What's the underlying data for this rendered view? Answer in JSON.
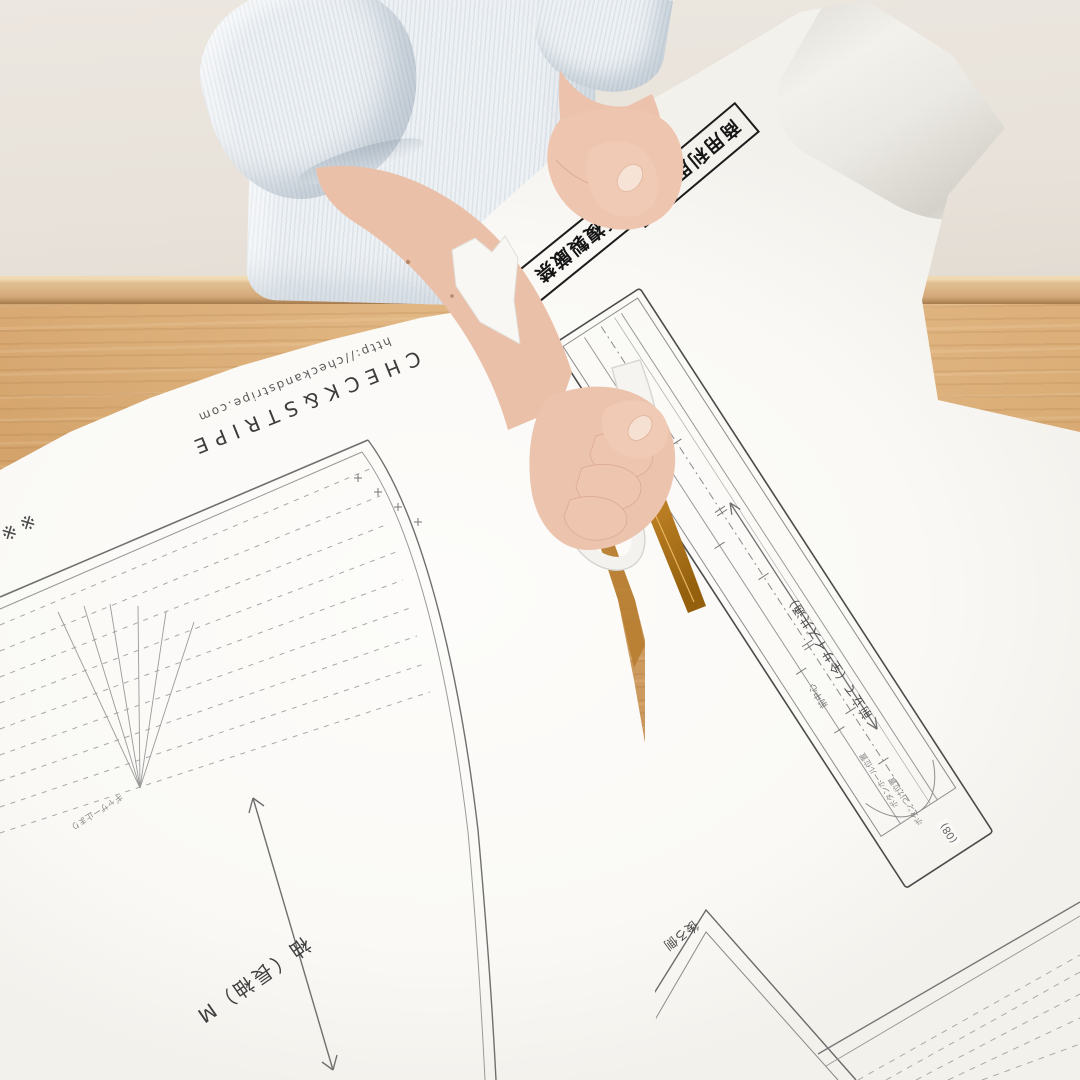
{
  "palette": {
    "wall": "#ece7e0",
    "board": "#d3a878",
    "wood": "#cd9a5f",
    "paper": "#faf9f6",
    "shirt": "#e6ebef",
    "skin": "#ecc3ad",
    "blade": "#b97f33",
    "ink": "#3e3e3e"
  },
  "brand": {
    "name": "CHECK&STRIPE",
    "url": "http://checkandstripe.com"
  },
  "warnings": {
    "no_commercial": "商用利用不可",
    "no_copy": "無断複製厳禁"
  },
  "right_piece": {
    "name": "前立て（全サイズ共通）",
    "center_front": "前中心",
    "tiny_label_1": "ボタンホール位置",
    "tiny_label_2": "ボタンつけ位置",
    "number": "(08)",
    "back_side": "後ろ側"
  },
  "left_piece": {
    "grain_label": "袖（長袖）M",
    "note_marks": "※※",
    "gather_label": "ギャザー止まり"
  }
}
